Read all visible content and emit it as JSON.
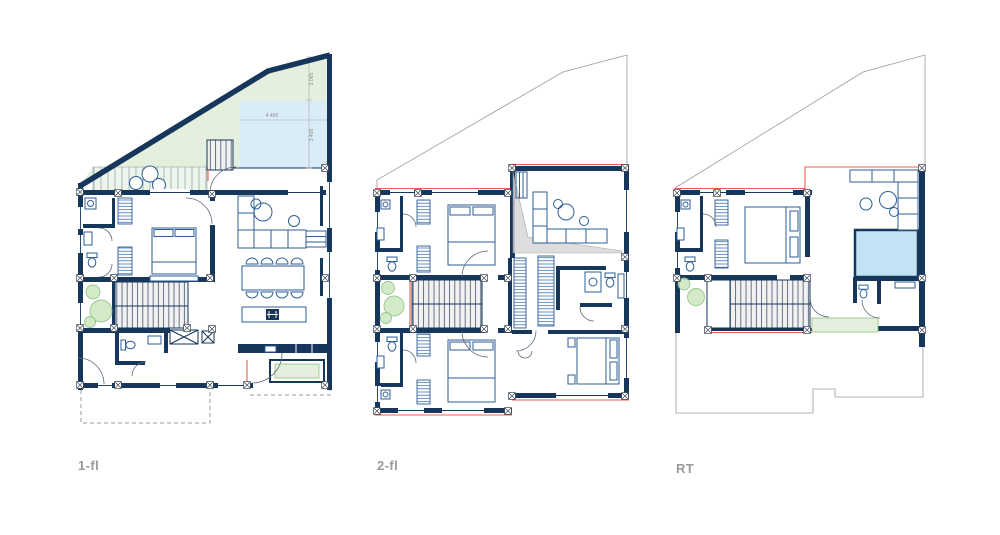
{
  "page": {
    "background": "#ffffff"
  },
  "palette": {
    "wall": "#16365c",
    "furniture": "#2d5e96",
    "terrace_green": "#e4f0dd",
    "water_blue": "#d9ecf8",
    "pool_blue": "#c3e3f4",
    "plant_green": "#cfe8c4",
    "plant_stroke": "#8fbf83",
    "roof_accent": "#e8604c",
    "shade_gray": "#d8d8d8",
    "boundary_gray": "#9b9b9b",
    "label_gray": "#9a9a9a"
  },
  "plans": [
    {
      "id": "1-fl",
      "label": "1-fl",
      "dims": {
        "terrace_depth": "2.065",
        "water_width": "4.400",
        "water_depth": "3.405"
      }
    },
    {
      "id": "2-fl",
      "label": "2-fl"
    },
    {
      "id": "rt",
      "label": "RT"
    }
  ]
}
